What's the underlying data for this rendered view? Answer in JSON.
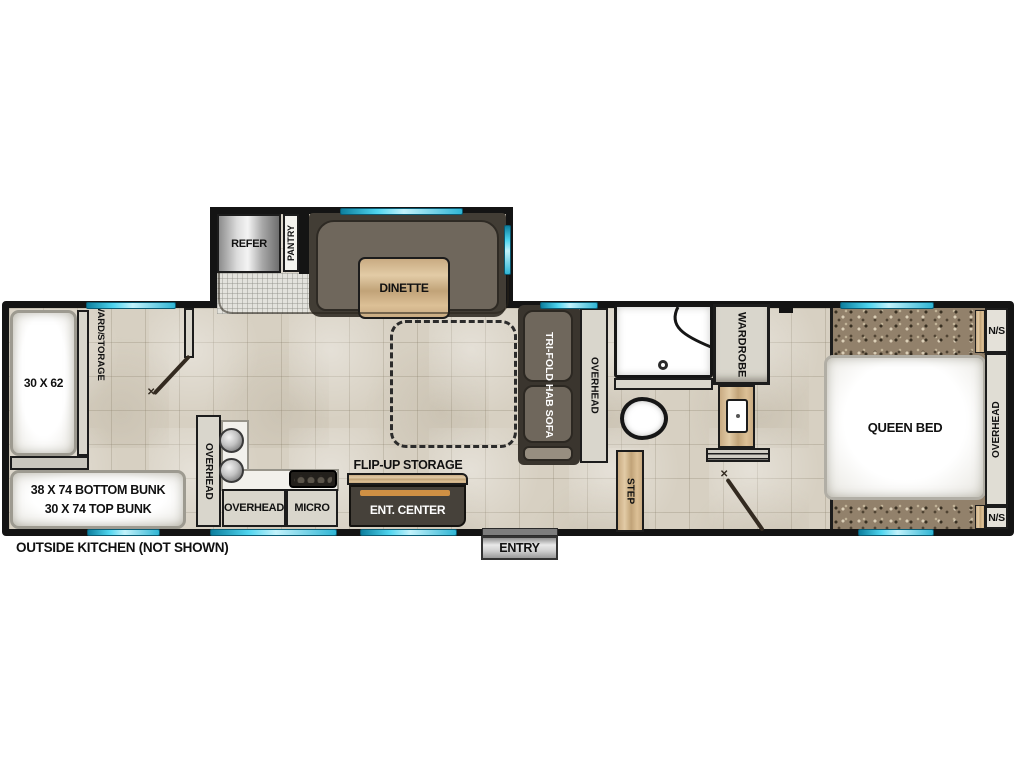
{
  "plan": {
    "labels": {
      "refer": "REFER",
      "pantry": "PANTRY",
      "dinette": "DINETTE",
      "ward_line1": "WARD/",
      "ward_line2": "STORAGE",
      "bed_30x62": "30 X 62",
      "bunk_line1": "38 X 74 BOTTOM BUNK",
      "bunk_line2": "30 X 74 TOP BUNK",
      "outside_kitchen": "OUTSIDE KITCHEN (NOT SHOWN)",
      "overhead": "OVERHEAD",
      "micro": "MICRO",
      "flip_up_storage": "FLIP-UP STORAGE",
      "ent_center": "ENT. CENTER",
      "tri_fold_sofa": "TRI-FOLD HAB SOFA",
      "step": "STEP",
      "entry": "ENTRY",
      "wardrobe": "WARDROBE",
      "queen_bed": "QUEEN BED",
      "ns_top": "N/S",
      "ns_bottom": "N/S"
    },
    "colors": {
      "wall": "#141414",
      "window_cyan": "#35c3e0",
      "accent_orange": "#cf9044",
      "cabinet_gray": "#d9d6cc",
      "wood_tan": "#cfb38c",
      "sofa_brown": "#6e665b",
      "carpet_brown": "#92816b",
      "tile_beige": "#d7d0c2"
    }
  }
}
